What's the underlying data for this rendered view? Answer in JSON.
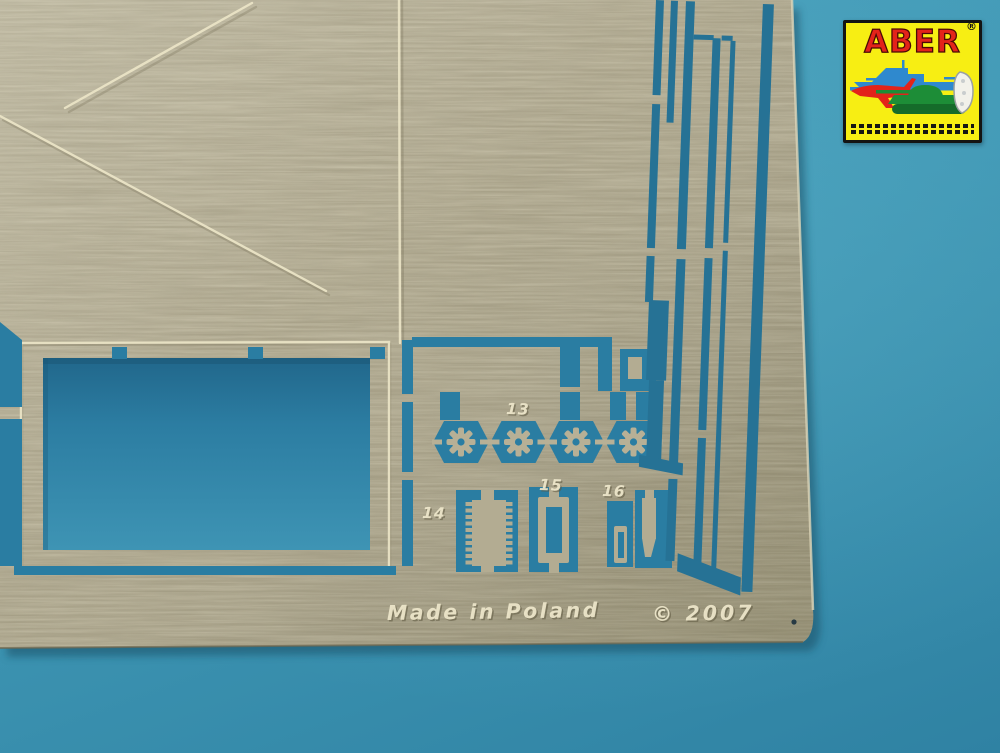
{
  "photo": {
    "subject": "photo-etched metal detail sheet on blue background"
  },
  "sheet": {
    "made_in_text": "Made in Poland",
    "copyright_text": "© 2007",
    "part_labels": [
      "13",
      "14",
      "15",
      "16"
    ],
    "gear_parts_count": 4
  },
  "logo": {
    "brand": "ABER",
    "registered_mark": "®",
    "icons": [
      "battleship-icon",
      "fighter-jet-icon",
      "tank-icon",
      "boat-icon"
    ],
    "barcode_rows": 2
  },
  "colors": {
    "background_blue": "#3F97B4",
    "cutout_blue": "#2A7DA2",
    "metal": "#A8A188",
    "etch_line": "#ECE5C8",
    "emboss_text": "#EFE8CC",
    "logo_yellow": "#F7EE13",
    "logo_red": "#E3231A",
    "logo_ship_blue": "#2F89CE",
    "logo_tank_green": "#1D8D37"
  }
}
